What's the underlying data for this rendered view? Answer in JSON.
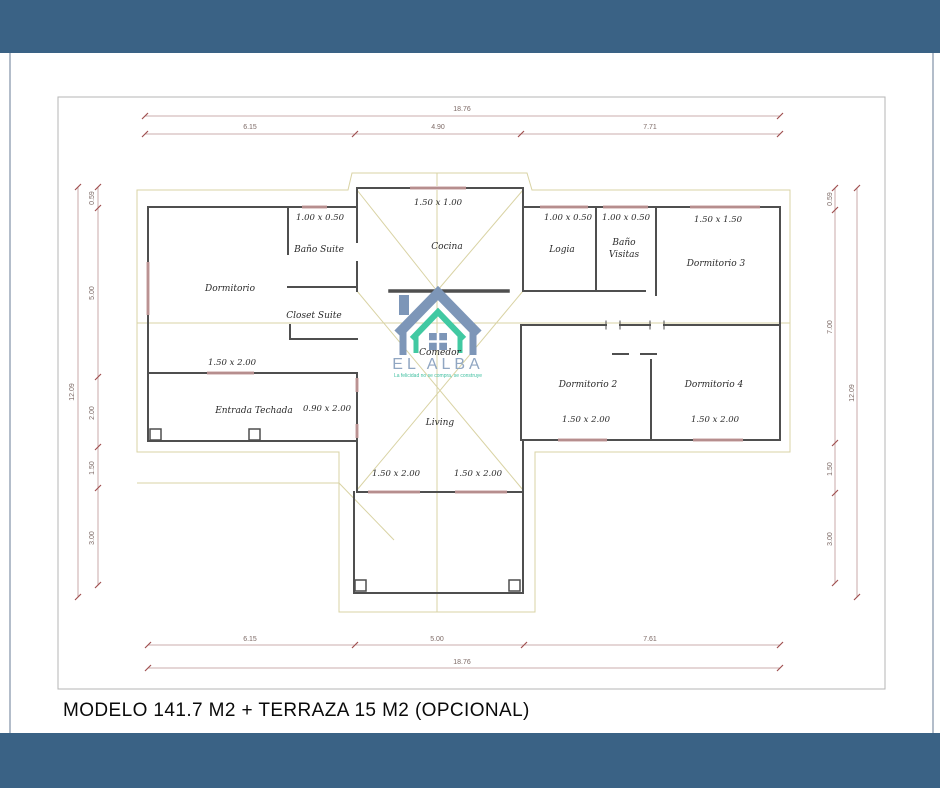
{
  "page": {
    "title": "MODELO 141.7 M2 + TERRAZA 15 M2 (OPCIONAL)",
    "colors": {
      "banner_blue": "#3a6285",
      "wall_gray": "#4f4f4f",
      "roof_yellow": "#d9d3a4",
      "window_pink": "#a87878",
      "dimension_red": "#a05050",
      "logo_blue": "#7d96b8",
      "logo_teal": "#41c9a2"
    }
  },
  "logo": {
    "name": "EL ALBA",
    "tagline": "La felicidad no se compra, se construye"
  },
  "plan": {
    "rooms": [
      {
        "label": "Dormitorio",
        "x": 230,
        "y": 291
      },
      {
        "label": "Baño Suite",
        "x": 319,
        "y": 252
      },
      {
        "label": "Closet Suite",
        "x": 314,
        "y": 318
      },
      {
        "label": "Cocina",
        "x": 447,
        "y": 249
      },
      {
        "label": "Logia",
        "x": 562,
        "y": 252
      },
      {
        "label": "Baño",
        "x": 624,
        "y": 245
      },
      {
        "label": "Visitas",
        "x": 624,
        "y": 257
      },
      {
        "label": "Dormitorio 3",
        "x": 716,
        "y": 266
      },
      {
        "label": "Comedor",
        "x": 440,
        "y": 355
      },
      {
        "label": "Entrada Techada",
        "x": 254,
        "y": 413
      },
      {
        "label": "Dormitorio 2",
        "x": 588,
        "y": 387
      },
      {
        "label": "Dormitorio 4",
        "x": 714,
        "y": 387
      },
      {
        "label": "Living",
        "x": 440,
        "y": 425
      }
    ],
    "window_labels": [
      {
        "text": "1.00 x 0.50",
        "x": 320,
        "y": 220
      },
      {
        "text": "1.50 x 2.00",
        "x": 232,
        "y": 365
      },
      {
        "text": "0.90 x 2.00",
        "x": 327,
        "y": 411
      },
      {
        "text": "1.50 x 1.00",
        "x": 438,
        "y": 205
      },
      {
        "text": "1.00 x 0.50",
        "x": 568,
        "y": 220
      },
      {
        "text": "1.00 x 0.50",
        "x": 626,
        "y": 220
      },
      {
        "text": "1.50 x 1.50",
        "x": 718,
        "y": 222
      },
      {
        "text": "1.50 x 2.00",
        "x": 586,
        "y": 422
      },
      {
        "text": "1.50 x 2.00",
        "x": 715,
        "y": 422
      },
      {
        "text": "1.50 x 2.00",
        "x": 396,
        "y": 476
      },
      {
        "text": "1.50 x 2.00",
        "x": 478,
        "y": 476
      }
    ],
    "dim_labels": [
      {
        "text": "18.76",
        "x": 462,
        "y": 111
      },
      {
        "text": "6.15",
        "x": 250,
        "y": 129
      },
      {
        "text": "4.90",
        "x": 438,
        "y": 129
      },
      {
        "text": "7.71",
        "x": 650,
        "y": 129
      },
      {
        "text": "6.15",
        "x": 250,
        "y": 641
      },
      {
        "text": "5.00",
        "x": 437,
        "y": 641
      },
      {
        "text": "7.61",
        "x": 650,
        "y": 641
      },
      {
        "text": "18.76",
        "x": 462,
        "y": 664
      },
      {
        "text": "12.09",
        "x": 74,
        "y": 392,
        "rot": 1
      },
      {
        "text": "0.59",
        "x": 94,
        "y": 198,
        "rot": 1
      },
      {
        "text": "5.00",
        "x": 94,
        "y": 293,
        "rot": 1
      },
      {
        "text": "2.00",
        "x": 94,
        "y": 413,
        "rot": 1
      },
      {
        "text": "1.50",
        "x": 94,
        "y": 468,
        "rot": 1
      },
      {
        "text": "3.00",
        "x": 94,
        "y": 538,
        "rot": 1
      },
      {
        "text": "0.59",
        "x": 832,
        "y": 199,
        "rot": 1
      },
      {
        "text": "7.00",
        "x": 832,
        "y": 327,
        "rot": 1
      },
      {
        "text": "1.50",
        "x": 832,
        "y": 469,
        "rot": 1
      },
      {
        "text": "3.00",
        "x": 832,
        "y": 539,
        "rot": 1
      },
      {
        "text": "12.09",
        "x": 854,
        "y": 393,
        "rot": 1
      }
    ]
  }
}
